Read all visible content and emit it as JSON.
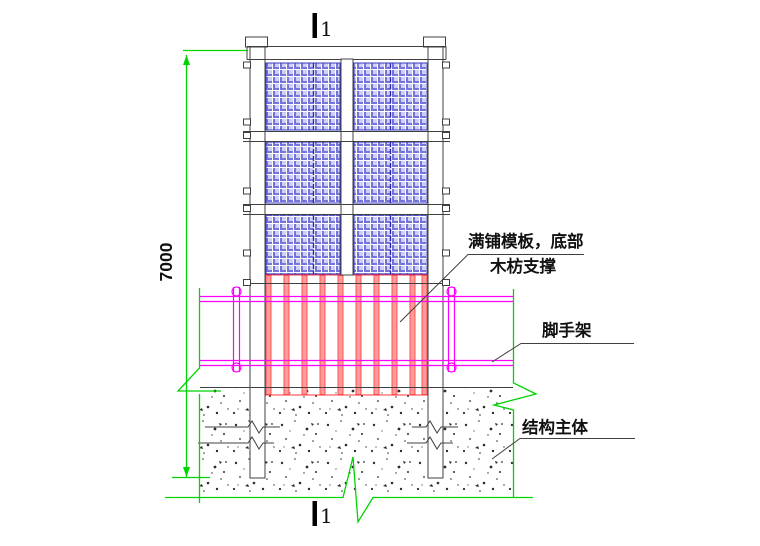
{
  "drawing": {
    "type": "construction-detail-section",
    "dimension_label": "7000",
    "section_mark_top": "1",
    "section_mark_bottom": "1",
    "callouts": {
      "formwork_line1": "满铺模板，底部",
      "formwork_line2": "木枋支撑",
      "scaffold": "脚手架",
      "structure": "结构主体"
    },
    "colors": {
      "safety_net_blue": "#7474da",
      "formwork_red": "#ff4444",
      "scaffold_magenta": "#ff00ff",
      "dimension_green": "#00d400",
      "line_dark": "#404040"
    }
  }
}
